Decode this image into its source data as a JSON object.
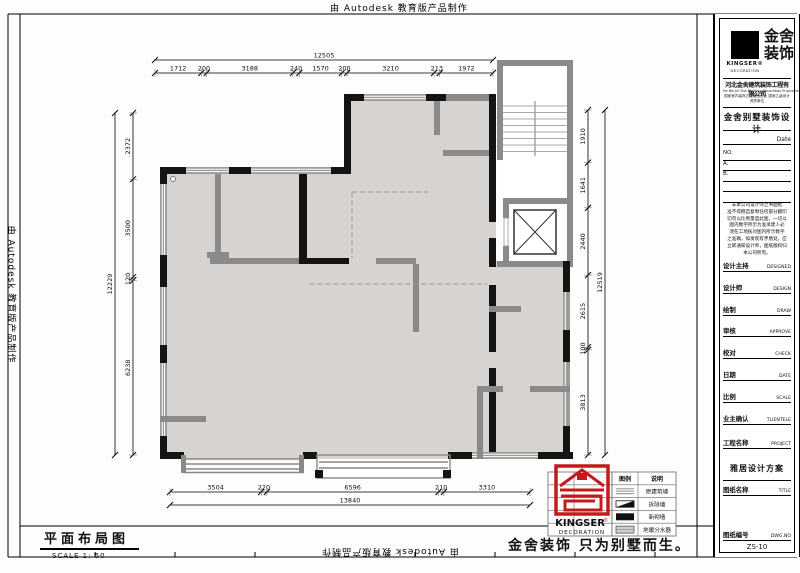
{
  "watermark_text": "由 Autodesk 教育版产品制作",
  "drawing": {
    "label": "平面布局图",
    "scale": "SCALE 1: 50",
    "slogan": "金舍装饰 只为别墅而生。"
  },
  "dimensions": {
    "top": {
      "total": "12505",
      "segments": [
        "1712",
        "200",
        "3188",
        "240",
        "1570",
        "200",
        "3210",
        "213",
        "1972"
      ]
    },
    "bottom": {
      "total": "13840",
      "segments": [
        "3504",
        "220",
        "6596",
        "210",
        "3310"
      ]
    },
    "left": {
      "total": "12229",
      "segments": [
        "2372",
        "3500",
        "120",
        "6238"
      ]
    },
    "right": {
      "total": "12519",
      "segments": [
        "1910",
        "1641",
        "2440",
        "2615",
        "100",
        "3813"
      ]
    }
  },
  "legend": {
    "headers": [
      "图例",
      "说明"
    ],
    "rows": [
      {
        "symbol": "original-wall",
        "label": "原建筑墙"
      },
      {
        "symbol": "demolish-wall",
        "label": "拆除墙"
      },
      {
        "symbol": "new-wall",
        "label": "新砌墙"
      },
      {
        "symbol": "manifold",
        "label": "地暖分水器"
      }
    ]
  },
  "stamp": {
    "name": "KINGSER",
    "reg": "®",
    "sub": "DECORATION"
  },
  "titleblock": {
    "logo_name": "KINGSER®",
    "logo_sub": "DECORATION",
    "brand_l1": "金舍",
    "brand_l2": "装饰",
    "company": "河北金舍建筑装饰工程有限公司",
    "company_en": "He Bei Jin She Building Decoration Engineering Co.,Ltd",
    "company_cert": "国家室内装饰乙级施工企业 国家乙级设计资质单位",
    "project_type": "金舍别墅装饰设计",
    "date_label": "Date",
    "no_lines": [
      "NO.",
      "A.",
      "B.",
      "",
      ""
    ],
    "disclaimer": [
      "非本公司设计师之书面批",
      "准不得擅自复制任何部分翻印",
      "切勿以比例量度此图，一切以",
      "图内数字所示为准承建人必",
      "须在工地核对图内所示数字",
      "之准确，如发现有矛盾处，应",
      "立即通知设计师，图纸版权归",
      "本公司所有。"
    ],
    "fields": [
      {
        "cn": "设计主持",
        "en": "DESIGNED"
      },
      {
        "cn": "设计师",
        "en": "DESIGN"
      },
      {
        "cn": "绘制",
        "en": "DRAW"
      },
      {
        "cn": "审核",
        "en": "APPROVE"
      },
      {
        "cn": "校对",
        "en": "CHECK"
      },
      {
        "cn": "日期",
        "en": "DATE"
      },
      {
        "cn": "比例",
        "en": "SCALE"
      },
      {
        "cn": "业主确认",
        "en": "TLIENTELE"
      }
    ],
    "project_label": "工程名称",
    "project_en": "PROJECT",
    "project_value": "雅居设计方案",
    "title_label": "图纸名称",
    "title_en": "TITLE",
    "dwg_label": "图纸编号",
    "dwg_en": "DWG.NO",
    "dwg_value": "ZS-10",
    "address": "中国河北省石家庄市槐安东路145号西美五洲天地商务金舍装饰  石家庄  TEL （86） 0311-88995555"
  }
}
